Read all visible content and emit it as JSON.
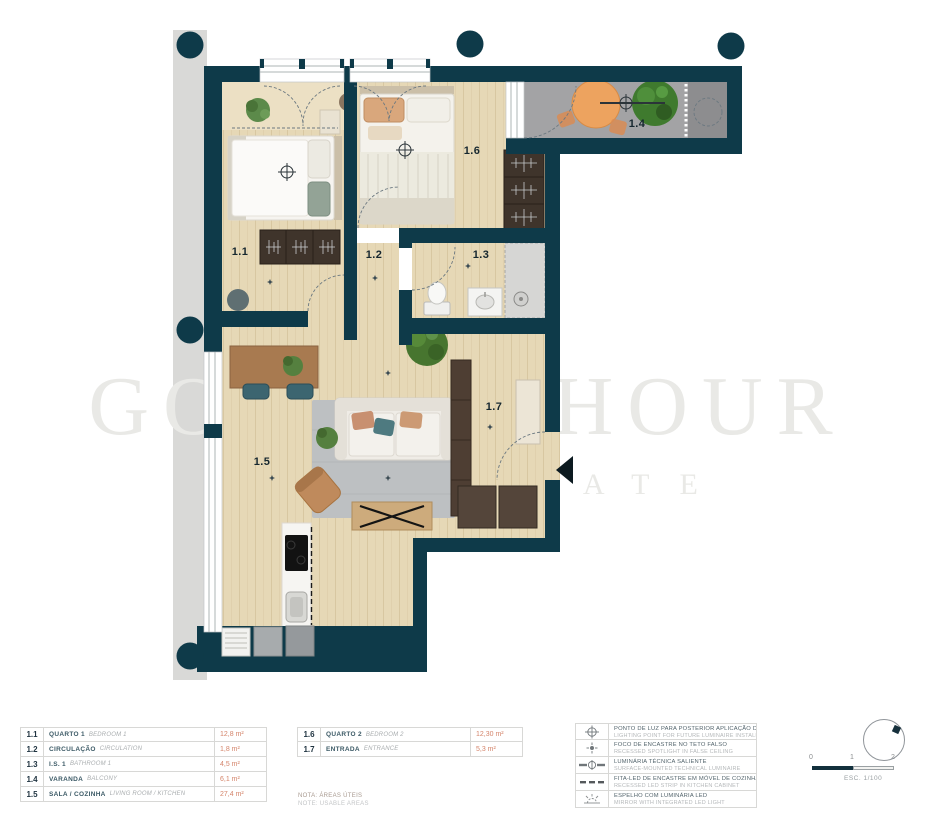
{
  "watermark": {
    "l1": "GOLDEN HOUR",
    "l2": "REAL ESTATE"
  },
  "plan_labels": {
    "r11": "1.1",
    "r12": "1.2",
    "r13": "1.3",
    "r14": "1.4",
    "r15": "1.5",
    "r16": "1.6",
    "r17": "1.7"
  },
  "legend_rooms_a": [
    {
      "code": "1.1",
      "pt": "QUARTO 1",
      "en": "BEDROOM 1",
      "area": "12,8 m²"
    },
    {
      "code": "1.2",
      "pt": "CIRCULAÇÃO",
      "en": "CIRCULATION",
      "area": "1,8 m²"
    },
    {
      "code": "1.3",
      "pt": "I.S. 1",
      "en": "BATHROOM 1",
      "area": "4,5 m²"
    },
    {
      "code": "1.4",
      "pt": "VARANDA",
      "en": "BALCONY",
      "area": "6,1 m²"
    },
    {
      "code": "1.5",
      "pt": "SALA / COZINHA",
      "en": "LIVING ROOM / KITCHEN",
      "area": "27,4 m²"
    }
  ],
  "legend_rooms_b": [
    {
      "code": "1.6",
      "pt": "QUARTO 2",
      "en": "BEDROOM 2",
      "area": "12,30 m²"
    },
    {
      "code": "1.7",
      "pt": "ENTRADA",
      "en": "ENTRANCE",
      "area": "5,3 m²"
    }
  ],
  "notes": {
    "l1": "NOTA: ÁREAS ÚTEIS",
    "l2": "NOTE: USABLE AREAS"
  },
  "legend_symbols": [
    {
      "pt": "PONTO DE LUZ PARA POSTERIOR APLICAÇÃO DE LUMINÁRIA",
      "en": "LIGHTING POINT FOR FUTURE LUMINAIRE INSTALLATION"
    },
    {
      "pt": "FOCO DE ENCASTRE NO TETO FALSO",
      "en": "RECESSED SPOTLIGHT IN FALSE CEILING"
    },
    {
      "pt": "LUMINÁRIA TÉCNICA SALIENTE",
      "en": "SURFACE-MOUNTED TECHNICAL LUMINAIRE"
    },
    {
      "pt": "FITA-LED DE ENCASTRE EM MÓVEL DE COZINHA",
      "en": "RECESSED LED STRIP IN KITCHEN CABINET"
    },
    {
      "pt": "ESPELHO COM LUMINÁRIA LED",
      "en": "MIRROR WITH INTEGRATED LED LIGHT"
    }
  ],
  "scalebar": {
    "t0": "0",
    "t1": "1",
    "t2": "2",
    "label": "ESC. 1/100"
  },
  "colors": {
    "wall": "#0e3a49",
    "band": "#d9d9d7",
    "wood": "#e6d8b6",
    "balcony": "#a3a3a5",
    "area_text": "#d4846a"
  }
}
